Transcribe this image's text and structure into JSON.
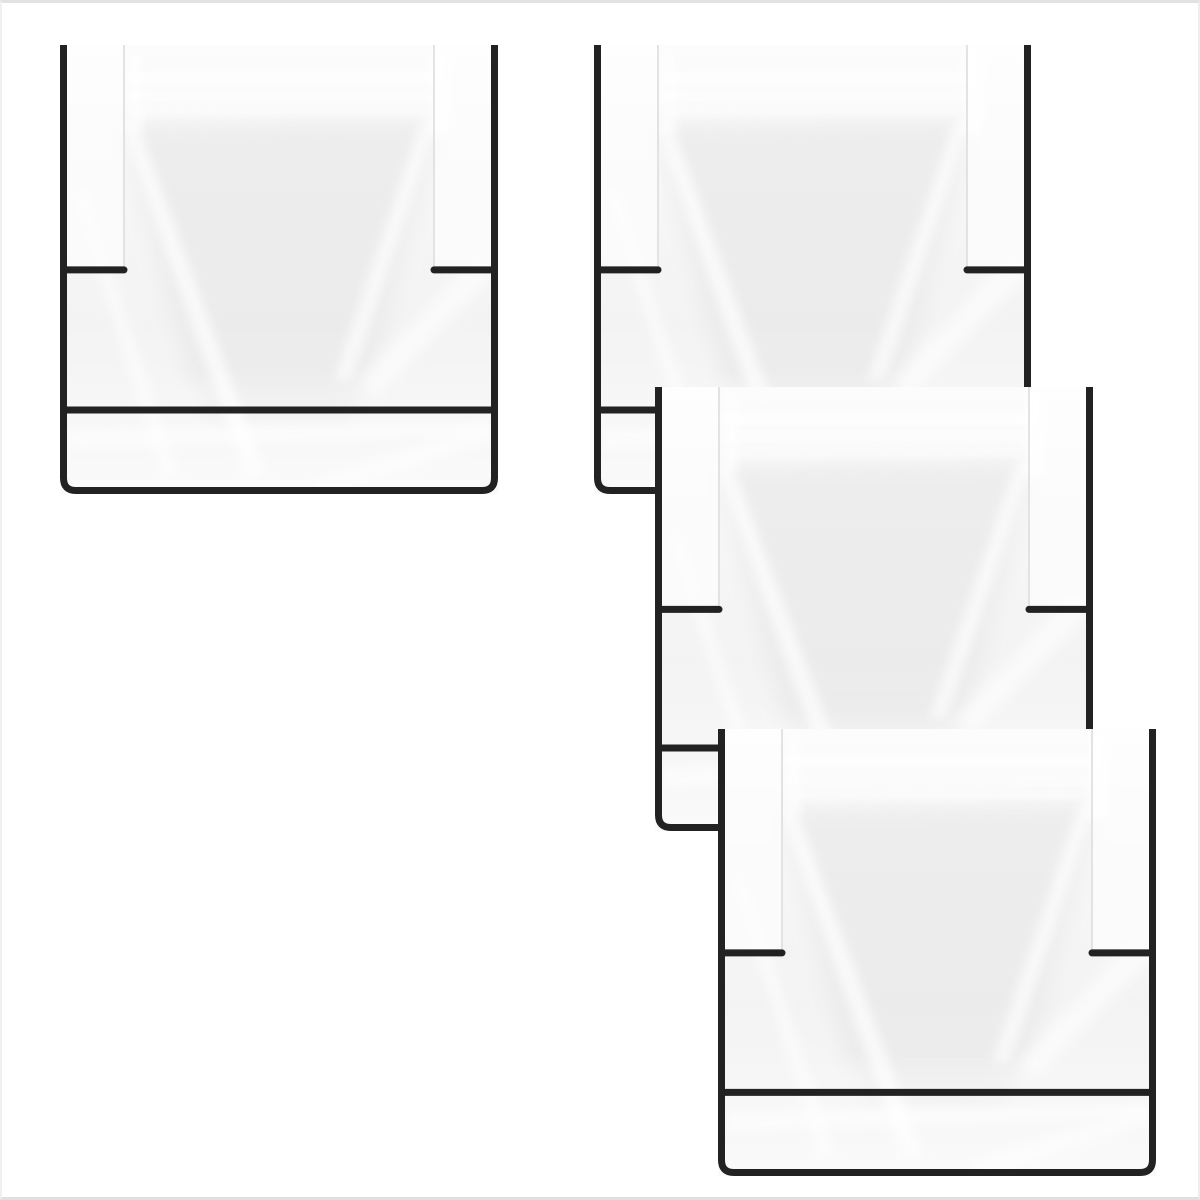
{
  "canvas": {
    "width": 1200,
    "height": 1200,
    "background_color": "#ffffff",
    "edge_tint_color": "#e2e2e2"
  },
  "scene": {
    "item_count": 4,
    "item_kind": "clear-plastic-bag"
  },
  "bag_style": {
    "outline_color": "#222222",
    "stroke_width": 7,
    "corner_radius": 16,
    "tick_length": 64,
    "tick_y_ratio": 0.501,
    "seal_y_ratio": 0.813,
    "lip_inset": 64,
    "film_light": "#fcfcfc",
    "film_mid": "#f3f3f3",
    "film_shade": "#e8e8e8",
    "sheen_color": "#ffffff",
    "lip_edge_color": "#dedede"
  },
  "bags": [
    {
      "name": "clear-bag-top-left",
      "x": 60,
      "y": 45,
      "width": 438,
      "height": 449,
      "z": 1
    },
    {
      "name": "clear-bag-top-right",
      "x": 594,
      "y": 45,
      "width": 437,
      "height": 449,
      "z": 2
    },
    {
      "name": "clear-bag-middle-right",
      "x": 655,
      "y": 387,
      "width": 438,
      "height": 444,
      "z": 3
    },
    {
      "name": "clear-bag-bottom-right",
      "x": 718,
      "y": 729,
      "width": 438,
      "height": 447,
      "z": 4
    }
  ]
}
